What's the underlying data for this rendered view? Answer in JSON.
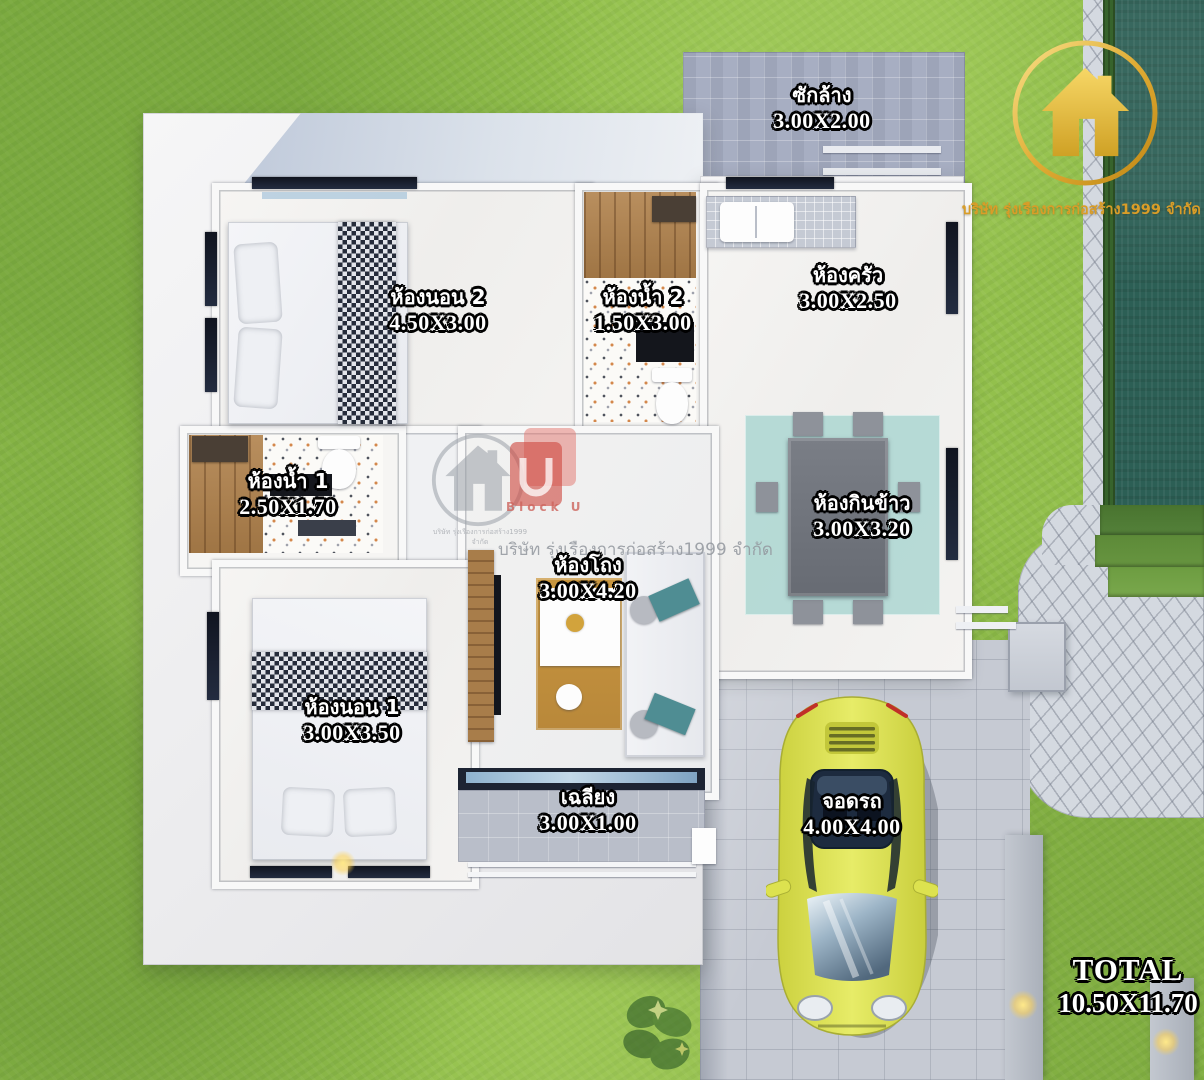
{
  "branding": {
    "company_gold": "บริษัท รุ่งเรืองการก่อสร้าง1999 จำกัด",
    "watermark": {
      "company": "บริษัท รุ่งเรืองการก่อสร้าง1999 จำกัด",
      "block_label": "Block U",
      "house_caption": "บริษัท รุ่งเรืองการก่อสร้าง1999 จำกัด"
    }
  },
  "rooms": [
    {
      "id": "laundry",
      "name": "ซักล้าง",
      "size": "3.00X2.00"
    },
    {
      "id": "bedroom2",
      "name": "ห้องนอน 2",
      "size": "4.50X3.00"
    },
    {
      "id": "bath2",
      "name": "ห้องน้ำ 2",
      "size": "1.50X3.00"
    },
    {
      "id": "kitchen",
      "name": "ห้องครัว",
      "size": "3.00X2.50"
    },
    {
      "id": "bath1",
      "name": "ห้องน้ำ 1",
      "size": "2.50X1.70"
    },
    {
      "id": "dining",
      "name": "ห้องกินข้าว",
      "size": "3.00X3.20"
    },
    {
      "id": "hall",
      "name": "ห้องโถง",
      "size": "3.00X4.20"
    },
    {
      "id": "bedroom1",
      "name": "ห้องนอน 1",
      "size": "3.00X3.50"
    },
    {
      "id": "porch",
      "name": "เฉลียง",
      "size": "3.00X1.00"
    },
    {
      "id": "parking",
      "name": "จอดรถ",
      "size": "4.00X4.00"
    }
  ],
  "total": {
    "label": "TOTAL",
    "size": "10.50X11.70"
  },
  "colors": {
    "grass": "#93c04c",
    "pool": "#2c5f55",
    "gold": "#d9a62e",
    "car": "#dde24f",
    "accent_teal": "#4f8d93"
  }
}
